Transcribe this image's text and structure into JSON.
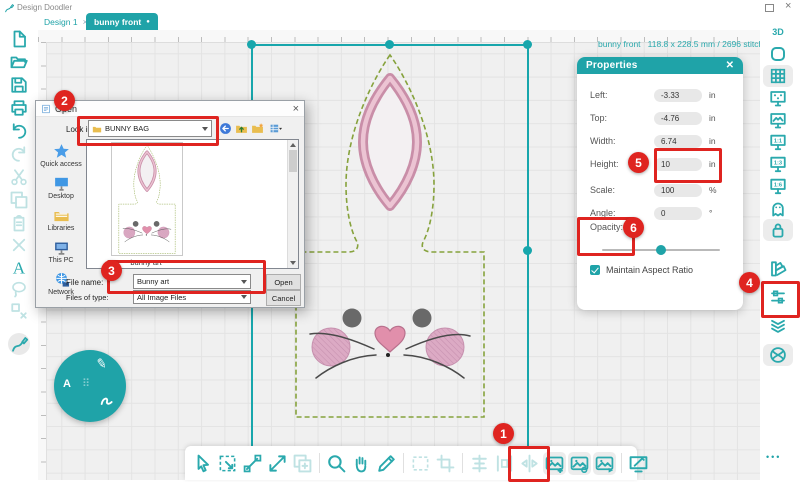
{
  "app": {
    "title": "Design Doodler"
  },
  "window": {
    "close_glyph": "×"
  },
  "tabs": [
    {
      "label": "Design 1",
      "close_glyph": "×",
      "active": false
    },
    {
      "label": "bunny front",
      "dot_glyph": "●",
      "active": true
    }
  ],
  "status_text": "bunny front   118.8 x 228.5 mm / 2696 stitches",
  "left_toolbar": {
    "items": [
      {
        "name": "new-document-icon"
      },
      {
        "name": "open-folder-icon"
      },
      {
        "name": "save-icon"
      },
      {
        "name": "print-icon"
      },
      {
        "name": "undo-icon"
      },
      {
        "name": "redo-icon",
        "dim": true
      },
      {
        "name": "cut-icon",
        "dim": true
      },
      {
        "name": "copy-icon",
        "dim": true
      },
      {
        "name": "paste-icon",
        "dim": true
      },
      {
        "name": "delete-icon",
        "dim": true
      },
      {
        "name": "text-icon"
      },
      {
        "name": "lasso-icon",
        "dim": true
      },
      {
        "name": "ungroup-icon",
        "dim": true
      },
      {
        "name": "doodle-pen-icon",
        "active": true
      }
    ]
  },
  "right_toolbar": {
    "items": [
      {
        "name": "view-3d-icon",
        "label": "3D"
      },
      {
        "name": "hoop-frame-icon"
      },
      {
        "name": "grid-view-icon",
        "bg": true
      },
      {
        "name": "screen-select-icon"
      },
      {
        "name": "screen-image-icon"
      },
      {
        "name": "screen-ratio-1-1-icon",
        "label": "1:1"
      },
      {
        "name": "screen-ratio-1-3-icon",
        "label": "1:3"
      },
      {
        "name": "screen-ratio-1-6-icon",
        "label": "1:6"
      },
      {
        "name": "ghost-mode-icon"
      },
      {
        "name": "lock-position-icon",
        "bg": true
      },
      {
        "name": "color-fan-icon"
      },
      {
        "name": "stitch-sliders-icon"
      },
      {
        "name": "layers-icon"
      },
      {
        "name": "stitch-ball-icon",
        "bg": true
      }
    ],
    "overflow_dots": "•••"
  },
  "bottom_toolbar": {
    "groups": [
      [
        {
          "name": "select-tool-icon"
        },
        {
          "name": "transform-tool-icon"
        },
        {
          "name": "node-edit-tool-icon"
        },
        {
          "name": "reshape-tool-icon"
        },
        {
          "name": "duplicate-tool-icon",
          "dim": true
        }
      ],
      [
        {
          "name": "zoom-tool-icon"
        },
        {
          "name": "pan-tool-icon"
        },
        {
          "name": "measure-tool-icon"
        }
      ],
      [
        {
          "name": "marquee-tool-icon",
          "dim": true
        },
        {
          "name": "crop-tool-icon",
          "dim": true
        }
      ],
      [
        {
          "name": "align-tool-icon",
          "dim": true
        },
        {
          "name": "distribute-tool-icon",
          "dim": true
        },
        {
          "name": "mirror-tool-icon",
          "dim": true
        },
        {
          "name": "import-image-tool-icon",
          "bg": true
        },
        {
          "name": "trace-image-tool-icon",
          "bg": true
        },
        {
          "name": "export-image-tool-icon",
          "bg": true
        }
      ],
      [
        {
          "name": "draw-screen-tool-icon"
        }
      ]
    ]
  },
  "fab": {
    "pen_glyph": "✎",
    "text_glyph": "A",
    "dots_glyph": "⠿"
  },
  "open_dialog": {
    "title": "Open",
    "close_glyph": "×",
    "look_in_label": "Look in:",
    "look_in_value": "BUNNY BAG",
    "places": [
      {
        "name": "quick-access",
        "label": "Quick access"
      },
      {
        "name": "desktop",
        "label": "Desktop"
      },
      {
        "name": "libraries",
        "label": "Libraries"
      },
      {
        "name": "this-pc",
        "label": "This PC"
      },
      {
        "name": "network",
        "label": "Network"
      }
    ],
    "thumb_label": "bunny art",
    "file_name_label": "File name:",
    "file_name_value": "Bunny art",
    "file_type_label": "Files of type:",
    "file_type_value": "All Image Files",
    "open_button": "Open",
    "cancel_button": "Cancel"
  },
  "properties_panel": {
    "title": "Properties",
    "close_glyph": "✕",
    "rows": [
      {
        "label": "Left:",
        "value": "-3.33",
        "unit": "in"
      },
      {
        "label": "Top:",
        "value": "-4.76",
        "unit": "in"
      },
      {
        "label": "Width:",
        "value": "6.74",
        "unit": "in"
      },
      {
        "label": "Height:",
        "value": "10",
        "unit": "in"
      },
      {
        "label": "Scale:",
        "value": "100",
        "unit": "%"
      },
      {
        "label": "Angle:",
        "value": "0",
        "unit": "°"
      }
    ],
    "opacity_label": "Opacity:",
    "opacity_percent": 50,
    "maintain_label": "Maintain Aspect Ratio",
    "maintain_checked": true
  },
  "callouts": {
    "badges": [
      "1",
      "2",
      "3",
      "4",
      "5",
      "6"
    ]
  },
  "colors": {
    "accent": "#1fa3a8",
    "callout_red": "#df2420",
    "stitch_green": "#86a23c",
    "stitch_pink": "#d9a4bc",
    "selection": "#17a6ac"
  }
}
